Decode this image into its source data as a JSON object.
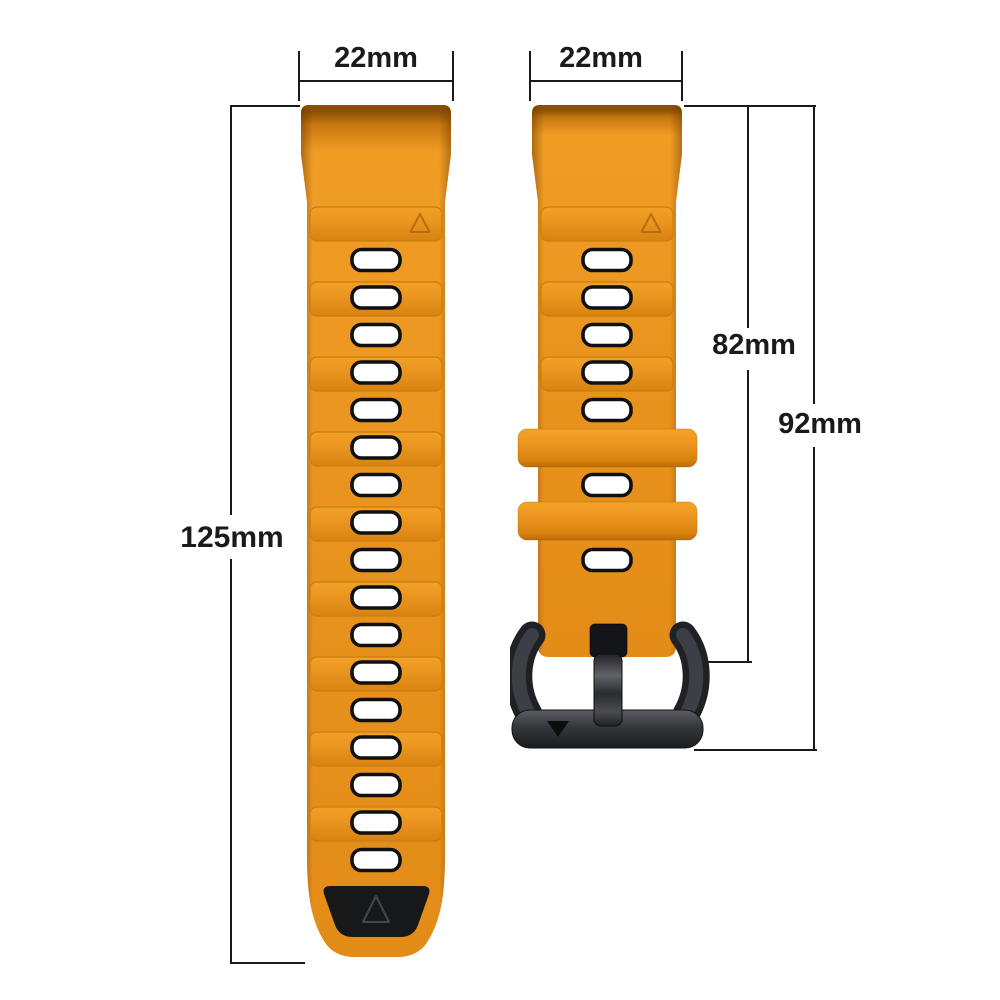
{
  "diagram": {
    "background_color": "#FFFFFF",
    "line_color": "#1A1A1A",
    "text_color": "#1A1A1A",
    "labels": {
      "left_strap_width": "22mm",
      "right_strap_width": "22mm",
      "left_strap_length": "125mm",
      "right_strap_length": "82mm",
      "right_total_length": "92mm"
    }
  },
  "product": {
    "strap_color": "#E8921E",
    "strap_edge_color": "#C0760E",
    "strap_highlight_color": "#F19D24",
    "hole_fill_color": "#FFFFFF",
    "hole_outline_color": "#101010",
    "tip_patch_color": "#17181A",
    "buckle_color": "#2B2D31",
    "left_strap": {
      "hole_count": 17,
      "ridge_count": 9,
      "has_tip_patch": true
    },
    "right_strap": {
      "hole_count": 7,
      "ridge_count": 3,
      "keeper_count": 2,
      "has_buckle": true
    }
  },
  "icons": {
    "triangle_up_mark": "△",
    "triangle_down_mark": "▼"
  }
}
